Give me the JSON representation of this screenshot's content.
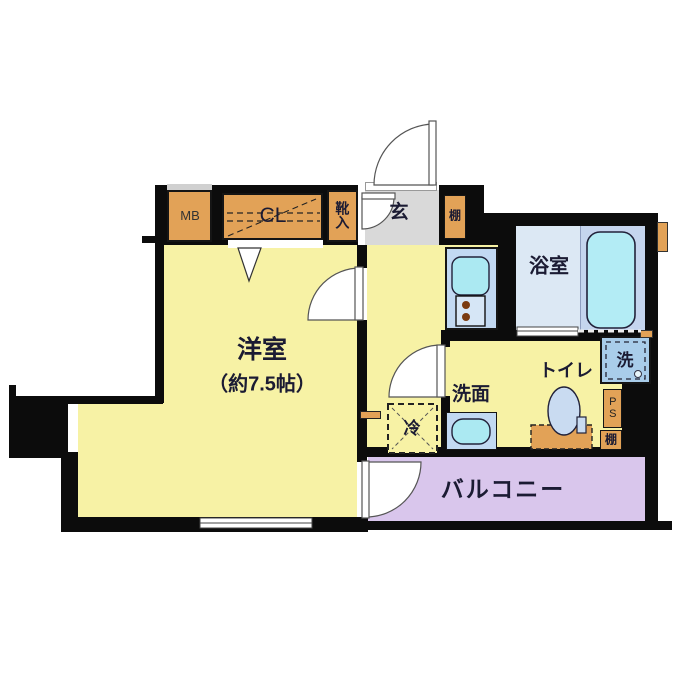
{
  "floorplan": {
    "rooms": {
      "western_room": {
        "name": "洋室",
        "size": "（約7.5帖）"
      },
      "entrance": {
        "name": "玄"
      },
      "bathroom": {
        "name": "浴室"
      },
      "washroom": {
        "name": "洗面"
      },
      "toilet": {
        "name": "トイレ"
      },
      "balcony": {
        "name": "バルコニー"
      }
    },
    "fixtures": {
      "meter_box": "MB",
      "closet": "CL",
      "shoe_cabinet": "靴入",
      "entrance_shelf": "棚",
      "refrigerator": "冷",
      "washing_machine": "洗",
      "pipe_space": "PS",
      "shelf": "棚"
    },
    "colors": {
      "wall": "#0c0c0c",
      "room_floor": "#f7f2a5",
      "entrance_floor": "#d9d9d9",
      "balcony_floor": "#d9c6ec",
      "bath_floor": "#dce8f4",
      "tub_zone_floor": "#c5d5ee",
      "tub_fill": "#b3ecf5",
      "counter_blue": "#c2d9f2",
      "sink_cyan": "#abe9f2",
      "washer_blue": "#a9cdea",
      "fixture_orange": "#e2a257"
    }
  }
}
